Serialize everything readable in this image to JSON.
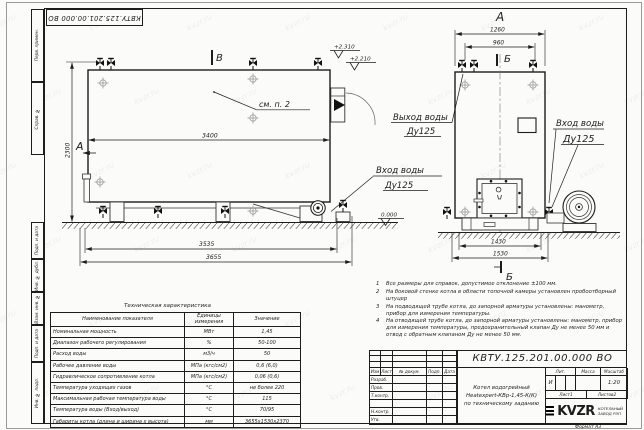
{
  "sheet": {
    "top_stamp": "КВТУ.125.201.00.000  ВО",
    "left_margin_top": [
      "Перв. примен.",
      "Справ. №"
    ],
    "left_margin_bottom": [
      "Подп. и дата",
      "Инв. № дубл.",
      "Взам. инв. №",
      "Подп. и дата",
      "Инв. № подл."
    ],
    "format_label": "Формат  А3",
    "watermark": "kvzr.ru"
  },
  "views": {
    "side": {
      "dim_3400": "3400",
      "dim_2300": "2300",
      "dim_3535": "3535",
      "dim_3655": "3655",
      "view_arrow": "А",
      "section_mark": "В",
      "see_note": "см. п. 2",
      "elev_top1": "+2.310",
      "elev_top2": "+2.210",
      "elev_zero": "0.000",
      "inlet_line1": "Вход воды",
      "inlet_line2": "Ду125"
    },
    "front": {
      "view_label": "А",
      "dim_1260": "1260",
      "dim_960": "960",
      "dim_1430": "1430",
      "dim_1530": "1530",
      "section_top": "Б",
      "section_bottom": "Б",
      "outlet_line1": "Выход воды",
      "outlet_line2": "Ду125",
      "inlet_line1": "Вход воды",
      "inlet_line2": "Ду125"
    }
  },
  "notes": [
    {
      "num": "1",
      "text": "Все размеры для справок, допустимое отклонение ±100 мм."
    },
    {
      "num": "2",
      "text": "На боковой стенке котла в области топочной камеры установлен пробоотборный штуцер"
    },
    {
      "num": "3",
      "text": "На подводящей трубе котла, до запорной арматуры установлены: манометр, прибор для измерения температуры."
    },
    {
      "num": "4",
      "text": "На отводящей трубе котла, до запорной арматуры установлены: манометр, прибор для измерения температуры, предохранительный клапан Ду не менее 50 мм и отвод с обратным клапаном Ду не менее 50 мм."
    }
  ],
  "tech_table": {
    "title": "Техническая характеристика",
    "headers": [
      "Наименование показателя",
      "Единицы измерения",
      "Значение"
    ],
    "rows": [
      [
        "Номинальная мощность",
        "МВт",
        "1,45"
      ],
      [
        "Диапазон рабочего регулирования",
        "%",
        "50-100"
      ],
      [
        "Расход воды",
        "м3/ч",
        "50"
      ],
      [
        "Рабочее давление воды",
        "МПа (кгс/см2)",
        "0,6 (6,0)"
      ],
      [
        "Гидравлическое сопротивление котла",
        "МПа (кгс/см2)",
        "0,06 (0,6)"
      ],
      [
        "Температура уходящих газов",
        "°С",
        "не более 220"
      ],
      [
        "Максимальная рабочая температура воды",
        "°С",
        "115"
      ],
      [
        "Температура воды (Вход/выход)",
        "°С",
        "70/95"
      ],
      [
        "Габариты котла (длина и ширина х высота)",
        "мм",
        "3655х1530х2370"
      ]
    ]
  },
  "title_block": {
    "doc_number": "КВТУ.125.201.00.000  ВО",
    "title_lines": [
      "Котел водогрейный",
      "Heatexpert-КВр-1,45-К(К)",
      "по техническому заданию"
    ],
    "rev_headers": [
      "Изм",
      "Лист",
      "№ докум.",
      "Подп.",
      "Дата"
    ],
    "row_labels": [
      "Разраб.",
      "Пров.",
      "Т.контр.",
      "",
      "Н.контр.",
      "Утв."
    ],
    "lit_header": "Лит.",
    "lit_value": "И",
    "mass_header": "Масса",
    "scale_header": "Масштаб",
    "scale_value": "1:20",
    "sheet_label": "Лист",
    "sheet_value": "1",
    "sheets_label": "Листов",
    "sheets_value": "2",
    "logo_text": "KVZR",
    "company": "КОТЕЛЬНЫЙ ЗАВОД РЭП"
  }
}
